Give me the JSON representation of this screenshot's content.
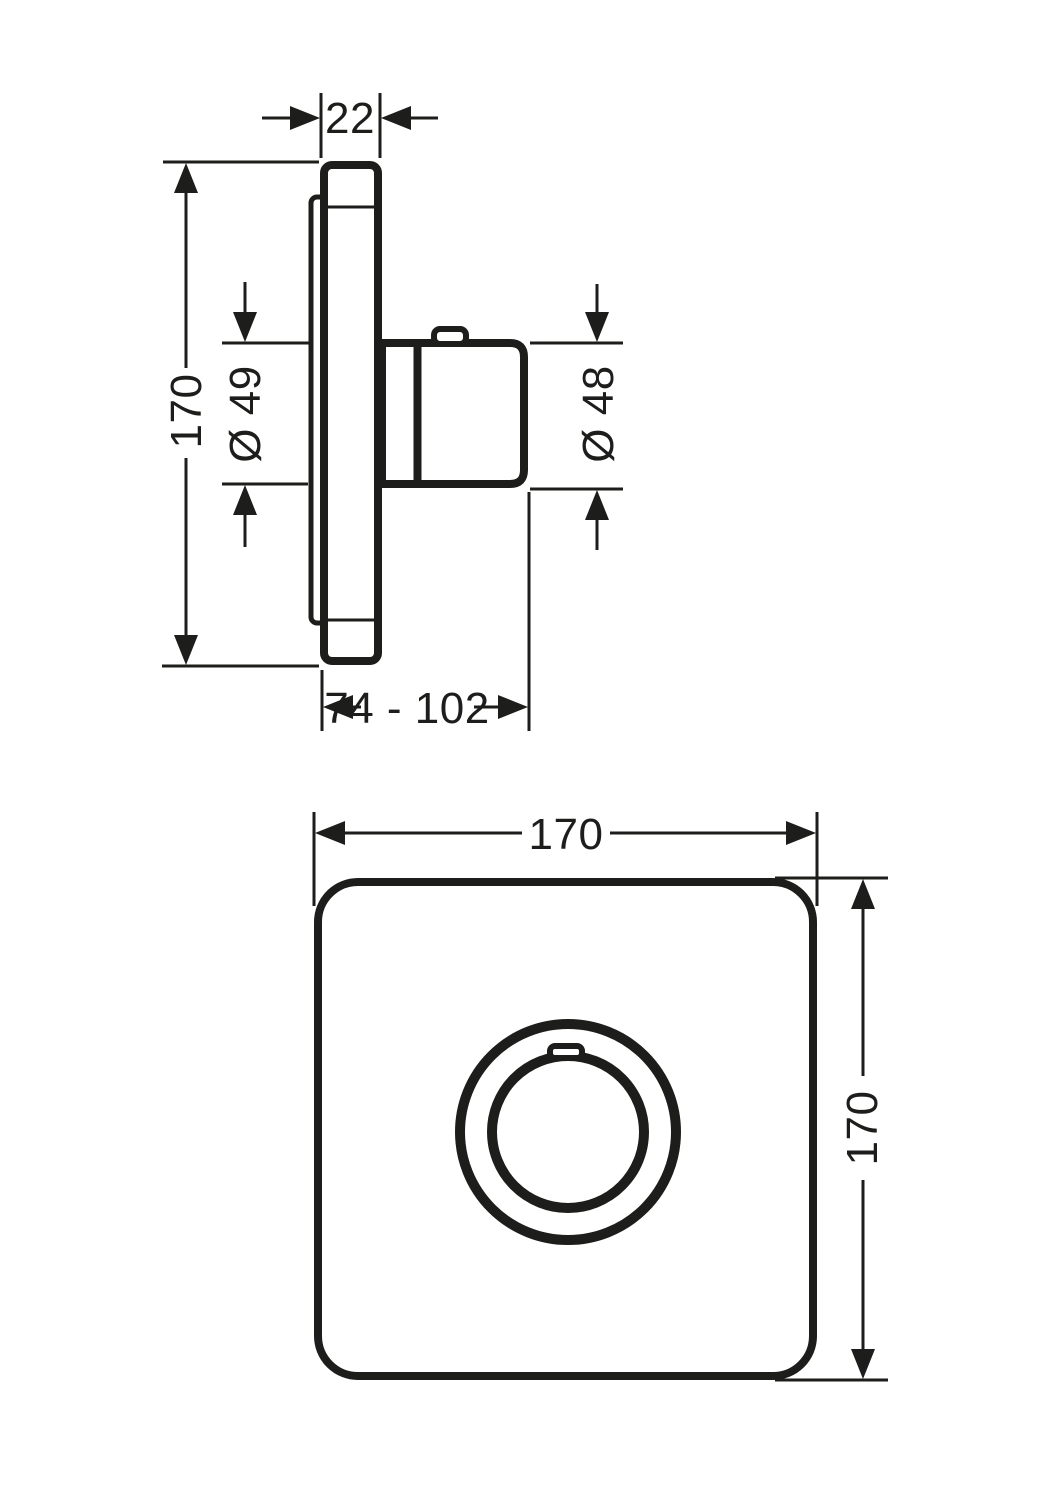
{
  "page": {
    "background": "#ffffff",
    "line_color": "#1d1d1b"
  },
  "views": {
    "side": {
      "dims": {
        "plate_thickness": "22",
        "height": "170",
        "sleeve_diameter": "Ø 49",
        "handle_diameter": "Ø 48",
        "depth_range": "74 - 102"
      }
    },
    "front": {
      "dims": {
        "width": "170",
        "height": "170"
      }
    }
  }
}
